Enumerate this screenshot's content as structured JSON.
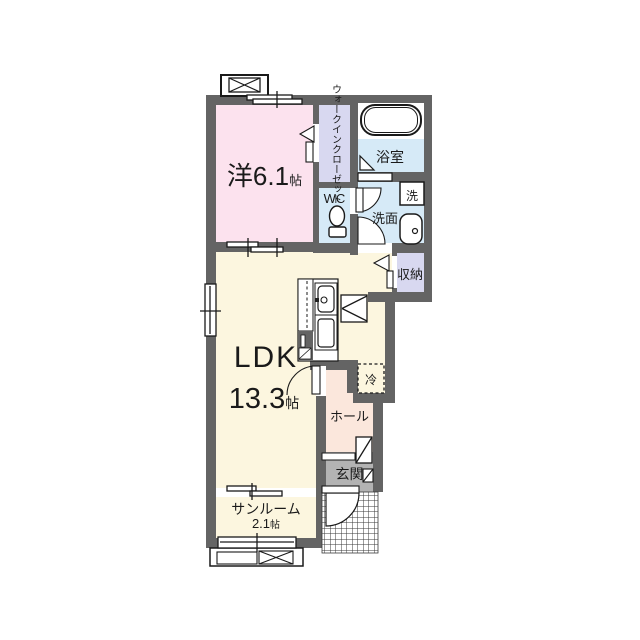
{
  "title": "1LDK apartment floor plan",
  "colors": {
    "wall": "#646464",
    "western_room": "#FCE2EE",
    "closet": "#D8D8F0",
    "wet_area": "#D6EAF7",
    "ldk": "#FCF6DF",
    "hall": "#FBE7DC",
    "entrance": "#B3B3B3"
  },
  "rooms": {
    "western": {
      "size": "洋6.1",
      "unit": "帖"
    },
    "walk_in_closet": {
      "line1": "ウォークイン",
      "line2": "クローゼット"
    },
    "wc": {
      "label": "WC"
    },
    "bathroom": {
      "label": "浴室"
    },
    "washroom": {
      "label": "洗面"
    },
    "washer": {
      "label": "洗"
    },
    "storage": {
      "label": "収納"
    },
    "ldk": {
      "label": "LDK",
      "size": "13.3",
      "unit": "帖"
    },
    "refrigerator": {
      "label": "冷"
    },
    "hall": {
      "label": "ホール"
    },
    "entrance": {
      "label": "玄関"
    },
    "sunroom": {
      "label": "サンルーム",
      "size": "2.1",
      "unit": "帖"
    }
  }
}
